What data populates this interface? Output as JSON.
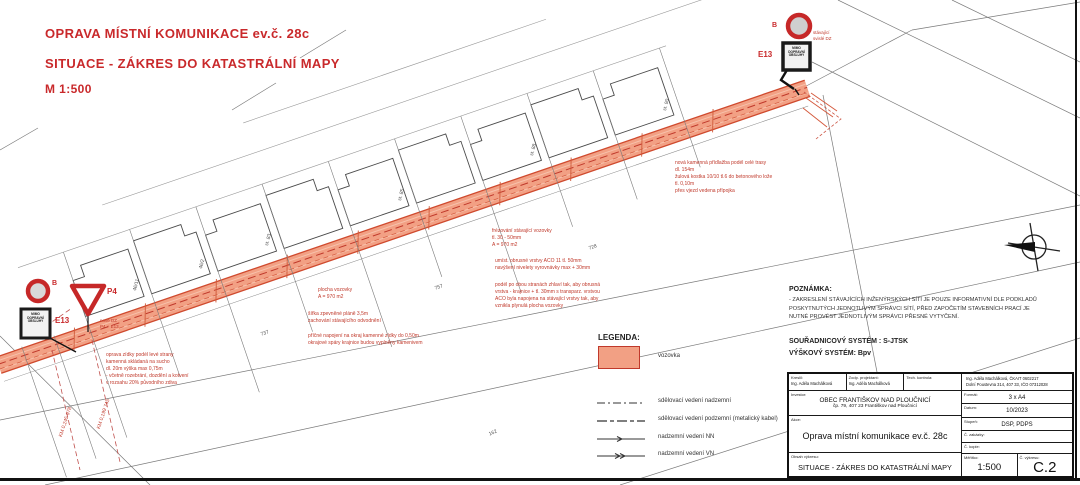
{
  "colors": {
    "title_red": "#c9292b",
    "annotation_red": "#c0392b",
    "road_fill": "#f2a084",
    "road_edge": "#cf4a2e",
    "sign_red": "#c62828",
    "line_dark": "#333333"
  },
  "title": {
    "l1": "OPRAVA MÍSTNÍ KOMUNIKACE ev.č. 28c",
    "l2": "SITUACE - ZÁKRES DO KATASTRÁLNÍ MAPY",
    "l3": "M 1:500"
  },
  "legend": {
    "title": "LEGENDA:",
    "road": "vozovka",
    "l1": "sdělovací vedení nadzemní",
    "l2": "sdělovací vedení podzemní (metalický kabel)",
    "l3": "nadzemní vedení NN",
    "l4": "nadzemní vedení VN"
  },
  "notes": {
    "heading": "POZNÁMKA:",
    "body": "- ZAKRESLENÍ STÁVAJÍCÍCH INŽENÝRSKÝCH SÍTÍ JE POUZE INFORMATIVNÍ DLE PODKLADŮ\nPOSKYTNUTÝCH JEDNOTLIVÝM SPRÁVCI SÍTÍ, PŘED ZAPOČETÍM STAVEBNÍCH PRACÍ JE\nNUTNÉ PROVÉST JEDNOTLIVÝM SPRÁVCI PŘESNÉ VYTYČENÍ.",
    "coord_system": "SOUŘADNICOVÝ SYSTÉM : S-JTSK",
    "height_system": "VÝŠKOVÝ SYSTÉM: Bpv"
  },
  "signs": {
    "b_label": "B",
    "e13_label": "E13",
    "p4_label": "P4",
    "plate_text": "MIMO\nDOPRAVNÍ\nOBSLUHY",
    "right_note": "stávající\nsvislé DZ",
    "p4_note": "nové DZ\nP4 + E13"
  },
  "annotations": {
    "curb": "nová kamenná přídlažba podél celé trasy\ndl. 154m\nžulová kostka 10/10 tl.6 do betonového lože\ntl. 0,10m\npřes vjezd vedena přípojka",
    "milling": "frézování stávající vozovky\ntl. 30 - 50mm\nA = 970 m2",
    "wearing": "umíst. obrusné vrstvy ACO 11 tl. 50mm\nnavýšení nivelety vyrovnávky max + 30mm",
    "leveling": "podél po obou stranách zhlaví tak, aby obrusná\nvrstva - krajnice + tl. 30mm s transparz. vrstvou\nACO byla napojena na stávající vrstvy tak, aby\nvznikla plynulá plocha vozovky",
    "area": "plocha vozovky\nA = 970 m2",
    "width": "šířka zpevněné pláně 3,5m\nzachování stávajícího odvodnění",
    "edge": "příčné napojení na okraj kamenné zídky do 0,50m\nokrajové spáry krajnice budou vyplněny kamenivem",
    "wall": "oprava zídky podél levé strany\nkamenná skládaná na sucho\ndl. 20m výška max 0,75m\n- včetně rozebrání, dozdění a kotvení\nv rozsahu 20% původního zdiva",
    "station1": "KM 0,245 978",
    "station2": "KM 0,199 745"
  },
  "parcels": {
    "p1": "46/11",
    "p2": "46/2",
    "p3": "st. 83",
    "p4": "st. 85",
    "p5": "st. 88",
    "p6": "st. 90",
    "p7": "737",
    "p8": "757",
    "p9": "728",
    "p10": "162"
  },
  "titleblock": {
    "kreslil_label": "Kreslil:",
    "kreslil": "Ing. Adéla Machálková",
    "zodp_label": "Zodp. projektant:",
    "zodp": "Ing. Adéla Machálková",
    "tech_label": "Tech. kontrola:",
    "tech": "",
    "author_block": "Ing. Adéla Machálková, ČKAIT 0602217\nDolní Poustevna 314, 407 33, IČO 07312028",
    "investor_label": "Investor:",
    "investor_name": "OBEC FRANTIŠKOV NAD PLOUČNICÍ",
    "investor_addr": "čp. 79, 407 23 Františkov nad Ploučnicí",
    "format_label": "Formát:",
    "format": "3 x A4",
    "datum_label": "Datum:",
    "datum": "10/2023",
    "stupen_label": "Stupeň:",
    "stupen": "DSP, PDPS",
    "zakazka_label": "Č. zakázky:",
    "kopie_label": "Č. kopie:",
    "akce_label": "Akce:",
    "akce": "Oprava místní komunikace ev.č. 28c",
    "obsah_label": "Obsah výkresu:",
    "obsah": "SITUACE - ZÁKRES DO KATASTRÁLNÍ MAPY",
    "meritko_label": "Měřítko:",
    "meritko": "1:500",
    "vykres_label": "Č. výkresu:",
    "vykres": "C.2"
  }
}
